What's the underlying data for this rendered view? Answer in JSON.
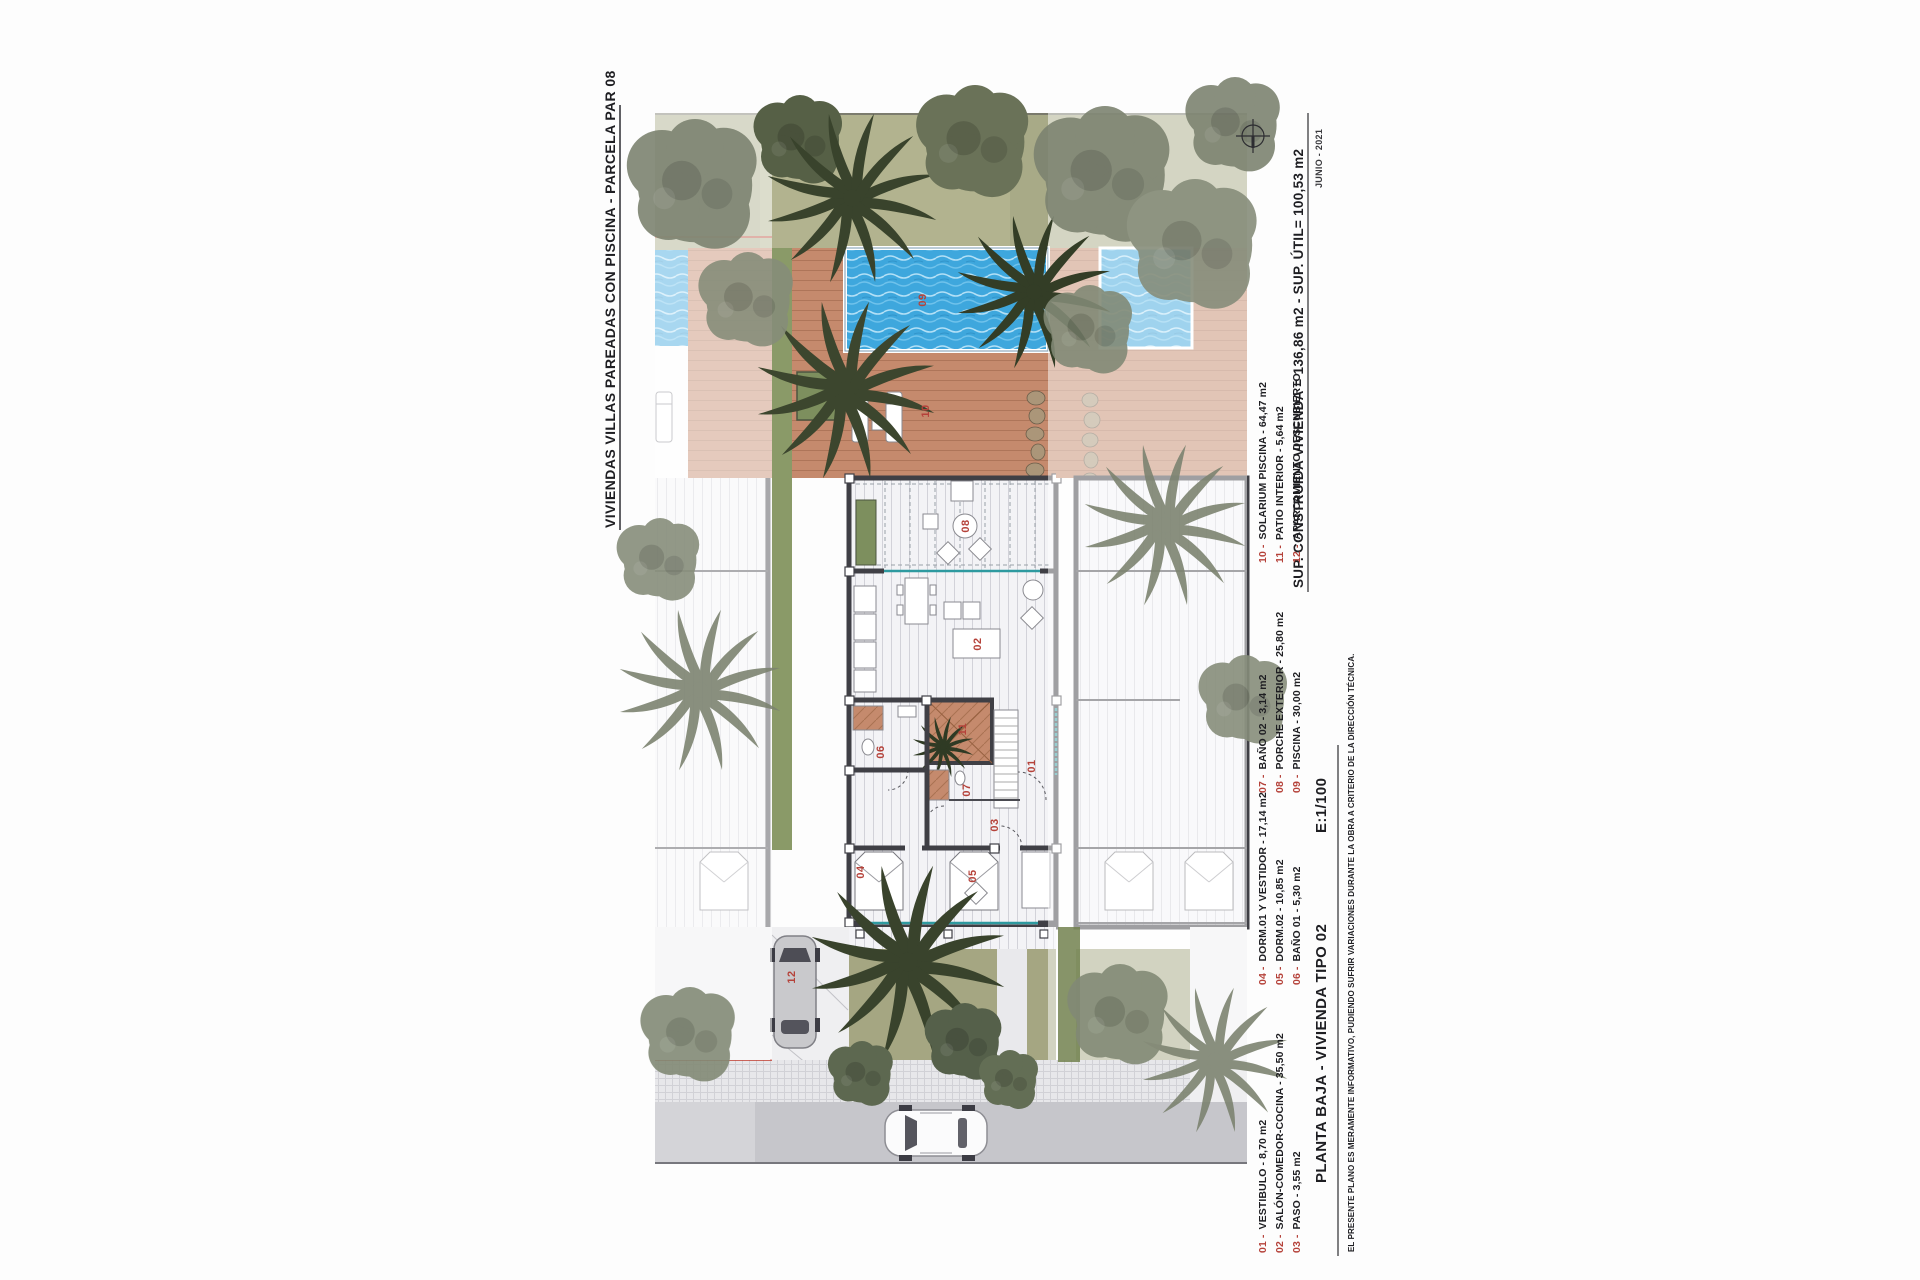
{
  "document": {
    "title_vertical": "VIVIENDAS VILLAS PAREADAS CON PISCINA - PARCELA PAR 08",
    "summary_line": "SUP. CONSTRUIDA VIVIENDA = 136,86 m2 - SUP. ÚTIL= 100,53 m2",
    "date": "JUNIO - 2021",
    "plan_title": "PLANTA BAJA - VIVIENDA TIPO 02",
    "scale": "E:1/100",
    "disclaimer": "EL PRESENTE PLANO ES MERAMENTE INFORMATIVO, PUDIENDO SUFRIR VARIACIONES DURANTE LA OBRA A CRITERIO DE LA DIRECCIÓN TÉCNICA."
  },
  "legend": {
    "groups": [
      {
        "items": [
          {
            "num": "01 -",
            "label": "VESTIBULO - 8,70 m2"
          },
          {
            "num": "02 -",
            "label": "SALÓN-COMEDOR-COCINA - 35,50 m2"
          },
          {
            "num": "03 -",
            "label": "PASO - 3,55 m2"
          }
        ]
      },
      {
        "items": [
          {
            "num": "04 -",
            "label": "DORM.01 Y VESTIDOR - 17,14 m2"
          },
          {
            "num": "05 -",
            "label": "DORM.02 - 10,85 m2"
          },
          {
            "num": "06 -",
            "label": "BAÑO 01 - 5,30 m2"
          }
        ]
      },
      {
        "items": [
          {
            "num": "07 -",
            "label": "BAÑO 02 - 3,14 m2"
          },
          {
            "num": "08 -",
            "label": "PORCHE EXTERIOR - 25,80 m2"
          },
          {
            "num": "09 -",
            "label": "PISCINA - 30,00 m2"
          }
        ]
      },
      {
        "items": [
          {
            "num": "10 -",
            "label": "SOLARIUM PISCINA - 64,47 m2"
          },
          {
            "num": "11 -",
            "label": "PATIO INTERIOR - 5,64 m2"
          },
          {
            "num": "12 -",
            "label": "APARCAMIENTO DESCUBIERTO"
          }
        ]
      }
    ]
  },
  "plan_labels": {
    "vestibulo": "01",
    "salon": "02",
    "paso": "03",
    "dorm01": "04",
    "dorm02": "05",
    "bano01": "06",
    "bano02": "07",
    "porche": "08",
    "piscina": "09",
    "solarium": "10",
    "patio": "11",
    "aparcamiento": "12"
  },
  "colors": {
    "label_red": "#b5423a",
    "pool_blue": "#3ea7dd",
    "deck": "#c58a6d",
    "lawn": "#a8aa87",
    "tree_dark": "#39432c",
    "tree_gray": "#7c8370",
    "wall": "#3f3f45",
    "road": "#c6c6cb"
  }
}
